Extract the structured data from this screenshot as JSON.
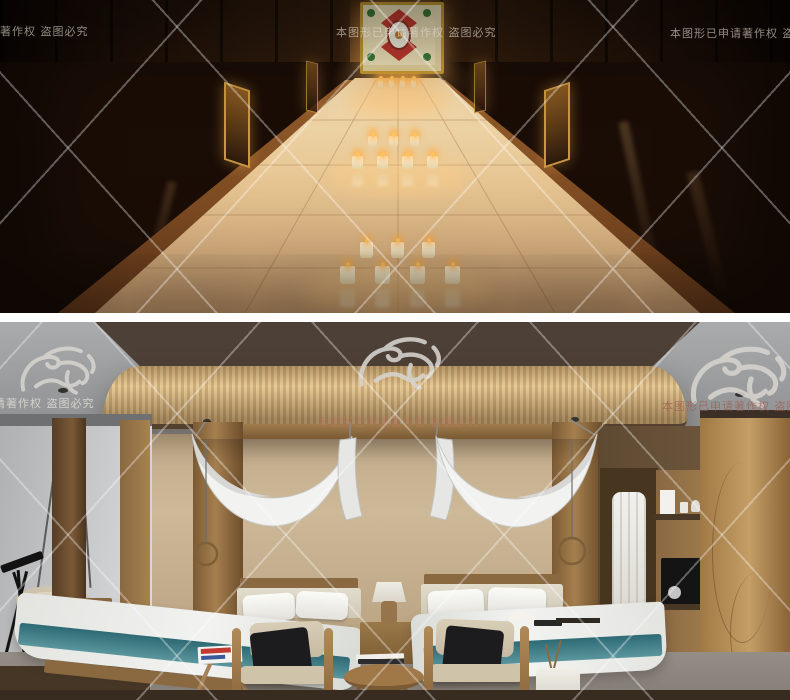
{
  "watermark": {
    "notice": "本图形已申请著作权  盗图必究",
    "logo_icon": "dragon-watermark",
    "line_color": "#ffffff",
    "text_color_light": "#e4dace",
    "text_color_red": "#9e584c"
  },
  "scenes": {
    "top": {
      "alt": "酒店走廊夜景效果图"
    },
    "bottom": {
      "alt": "酒店客房双床效果图"
    }
  },
  "colors": {
    "corridor_glow": "#e6c592",
    "corridor_wood": "#36200f",
    "bedroom_wall": "#cdb897",
    "teal_runner": "#2e6a74",
    "oak_wardrobe": "#c49e66"
  }
}
